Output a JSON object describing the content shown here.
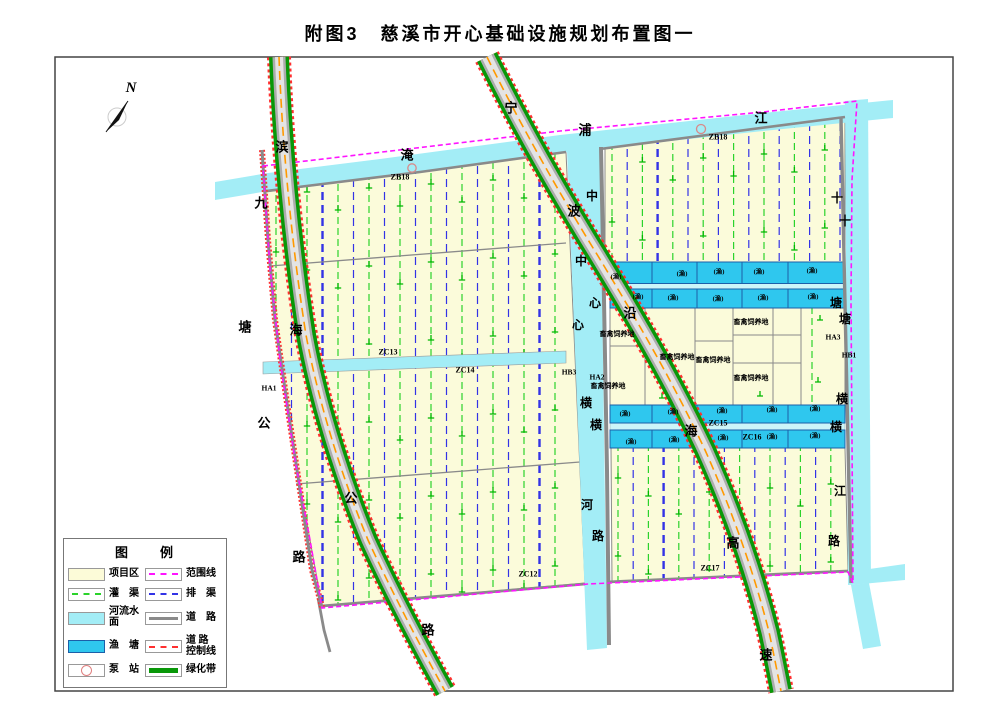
{
  "title": "附图3　慈溪市开心基础设施规划布置图一",
  "colors": {
    "parcel": "#FBFBDA",
    "river": "#A3EDF6",
    "channel_band": "#CDF5F9",
    "pond": "#2FC7EE",
    "pond_border": "#1C5FA8",
    "canal_green": "#2BD32B",
    "canal_blue": "#3333E6",
    "symbol_green": "#00B800",
    "boundary": "#FF14FF",
    "road_gray": "#8A8A8A",
    "road_light": "#E4E4E4",
    "green_belt": "#089808",
    "control_red": "#FF3030",
    "center_line": "#FF9900",
    "pump": "#D98A8A",
    "frame": "#444444",
    "label": "#000000"
  },
  "legend": {
    "title": "图　　例",
    "items_left": [
      {
        "name": "project-area",
        "label": "项目区",
        "swatch": "fill",
        "color": "#FCFBD8"
      },
      {
        "name": "irrigation-canal",
        "label": "灌　渠",
        "swatch": "dash",
        "color": "#2BD32B"
      },
      {
        "name": "river-surface",
        "label": "河流水面",
        "swatch": "fill",
        "color": "#A3EDF6"
      },
      {
        "name": "fish-pond",
        "label": "渔　塘",
        "swatch": "fill",
        "color": "#2FC7EE"
      },
      {
        "name": "pump-station",
        "label": "泵　站",
        "swatch": "pump",
        "color": "#E08080"
      }
    ],
    "items_right": [
      {
        "name": "boundary-line",
        "label": "范围线",
        "swatch": "dash",
        "color": "#FF14FF"
      },
      {
        "name": "drainage-canal",
        "label": "排　渠",
        "swatch": "dash",
        "color": "#3333E6"
      },
      {
        "name": "road",
        "label": "道　路",
        "swatch": "line",
        "color": "#8A8A8A"
      },
      {
        "name": "road-control-line",
        "label": "道 路\n控制线",
        "swatch": "dash",
        "color": "#FF3030"
      },
      {
        "name": "green-belt",
        "label": "绿化带",
        "swatch": "thick",
        "color": "#089808"
      }
    ]
  },
  "map": {
    "north_label": "N",
    "labels": [
      {
        "t": "滨",
        "x": 282,
        "y": 147,
        "s": 13
      },
      {
        "t": "海",
        "x": 296,
        "y": 330,
        "s": 13
      },
      {
        "t": "公",
        "x": 351,
        "y": 498,
        "s": 13
      },
      {
        "t": "路",
        "x": 428,
        "y": 630,
        "s": 13
      },
      {
        "t": "九",
        "x": 261,
        "y": 203,
        "s": 13
      },
      {
        "t": "塘",
        "x": 245,
        "y": 327,
        "s": 13
      },
      {
        "t": "公",
        "x": 264,
        "y": 423,
        "s": 13
      },
      {
        "t": "路",
        "x": 299,
        "y": 557,
        "s": 13
      },
      {
        "t": "宁",
        "x": 511,
        "y": 108,
        "s": 13
      },
      {
        "t": "波",
        "x": 574,
        "y": 211,
        "s": 13
      },
      {
        "t": "沿",
        "x": 630,
        "y": 313,
        "s": 13
      },
      {
        "t": "海",
        "x": 691,
        "y": 431,
        "s": 13
      },
      {
        "t": "高",
        "x": 733,
        "y": 543,
        "s": 13
      },
      {
        "t": "速",
        "x": 766,
        "y": 655,
        "s": 13
      },
      {
        "t": "淹",
        "x": 407,
        "y": 155,
        "s": 13
      },
      {
        "t": "浦",
        "x": 585,
        "y": 130,
        "s": 13
      },
      {
        "t": "江",
        "x": 761,
        "y": 118,
        "s": 13
      },
      {
        "t": "中",
        "x": 592,
        "y": 196,
        "s": 12
      },
      {
        "t": "中",
        "x": 581,
        "y": 261,
        "s": 12
      },
      {
        "t": "心",
        "x": 595,
        "y": 303,
        "s": 12
      },
      {
        "t": "心",
        "x": 578,
        "y": 325,
        "s": 12
      },
      {
        "t": "横",
        "x": 586,
        "y": 403,
        "s": 12
      },
      {
        "t": "横",
        "x": 596,
        "y": 425,
        "s": 12
      },
      {
        "t": "河",
        "x": 587,
        "y": 505,
        "s": 12
      },
      {
        "t": "路",
        "x": 598,
        "y": 536,
        "s": 12
      },
      {
        "t": "十",
        "x": 837,
        "y": 198,
        "s": 12
      },
      {
        "t": "十",
        "x": 845,
        "y": 221,
        "s": 12
      },
      {
        "t": "塘",
        "x": 836,
        "y": 303,
        "s": 12
      },
      {
        "t": "塘",
        "x": 845,
        "y": 319,
        "s": 12
      },
      {
        "t": "横",
        "x": 842,
        "y": 399,
        "s": 12
      },
      {
        "t": "横",
        "x": 836,
        "y": 427,
        "s": 12
      },
      {
        "t": "江",
        "x": 840,
        "y": 491,
        "s": 12
      },
      {
        "t": "路",
        "x": 834,
        "y": 541,
        "s": 12
      },
      {
        "t": "ZB18",
        "x": 400,
        "y": 177,
        "s": 8
      },
      {
        "t": "ZB18",
        "x": 718,
        "y": 137,
        "s": 8
      },
      {
        "t": "ZC13",
        "x": 388,
        "y": 352,
        "s": 8
      },
      {
        "t": "ZC14",
        "x": 465,
        "y": 370,
        "s": 8
      },
      {
        "t": "ZC15",
        "x": 718,
        "y": 423,
        "s": 8
      },
      {
        "t": "ZC16",
        "x": 752,
        "y": 437,
        "s": 8
      },
      {
        "t": "ZC12",
        "x": 528,
        "y": 574,
        "s": 8
      },
      {
        "t": "ZC17",
        "x": 710,
        "y": 568,
        "s": 8
      },
      {
        "t": "HA1",
        "x": 269,
        "y": 388,
        "s": 7.5
      },
      {
        "t": "HA2",
        "x": 597,
        "y": 377,
        "s": 7.5
      },
      {
        "t": "HA3",
        "x": 833,
        "y": 337,
        "s": 7.5
      },
      {
        "t": "HB1",
        "x": 849,
        "y": 355,
        "s": 7.5
      },
      {
        "t": "HB3",
        "x": 569,
        "y": 372,
        "s": 7.5
      },
      {
        "t": "畜禽饲养地",
        "x": 617,
        "y": 334,
        "s": 7
      },
      {
        "t": "畜禽饲养地",
        "x": 608,
        "y": 386,
        "s": 7
      },
      {
        "t": "畜禽饲养地",
        "x": 677,
        "y": 357,
        "s": 7
      },
      {
        "t": "畜禽饲养地",
        "x": 713,
        "y": 360,
        "s": 7
      },
      {
        "t": "畜禽饲养地",
        "x": 751,
        "y": 322,
        "s": 7
      },
      {
        "t": "畜禽饲养地",
        "x": 751,
        "y": 378,
        "s": 7
      },
      {
        "t": "(渔)",
        "x": 616,
        "y": 277,
        "s": 6.5
      },
      {
        "t": "(渔)",
        "x": 682,
        "y": 274,
        "s": 6.5
      },
      {
        "t": "(渔)",
        "x": 719,
        "y": 272,
        "s": 6.5
      },
      {
        "t": "(渔)",
        "x": 759,
        "y": 272,
        "s": 6.5
      },
      {
        "t": "(渔)",
        "x": 812,
        "y": 271,
        "s": 6.5
      },
      {
        "t": "(渔)",
        "x": 638,
        "y": 297,
        "s": 6.5
      },
      {
        "t": "(渔)",
        "x": 673,
        "y": 298,
        "s": 6.5
      },
      {
        "t": "(渔)",
        "x": 718,
        "y": 299,
        "s": 6.5
      },
      {
        "t": "(渔)",
        "x": 763,
        "y": 298,
        "s": 6.5
      },
      {
        "t": "(渔)",
        "x": 813,
        "y": 297,
        "s": 6.5
      },
      {
        "t": "(渔)",
        "x": 625,
        "y": 414,
        "s": 6.5
      },
      {
        "t": "(渔)",
        "x": 673,
        "y": 412,
        "s": 6.5
      },
      {
        "t": "(渔)",
        "x": 722,
        "y": 411,
        "s": 6.5
      },
      {
        "t": "(渔)",
        "x": 772,
        "y": 410,
        "s": 6.5
      },
      {
        "t": "(渔)",
        "x": 815,
        "y": 409,
        "s": 6.5
      },
      {
        "t": "(渔)",
        "x": 631,
        "y": 442,
        "s": 6.5
      },
      {
        "t": "(渔)",
        "x": 674,
        "y": 440,
        "s": 6.5
      },
      {
        "t": "(渔)",
        "x": 723,
        "y": 438,
        "s": 6.5
      },
      {
        "t": "(渔)",
        "x": 772,
        "y": 437,
        "s": 6.5
      },
      {
        "t": "(渔)",
        "x": 815,
        "y": 436,
        "s": 6.5
      }
    ]
  }
}
